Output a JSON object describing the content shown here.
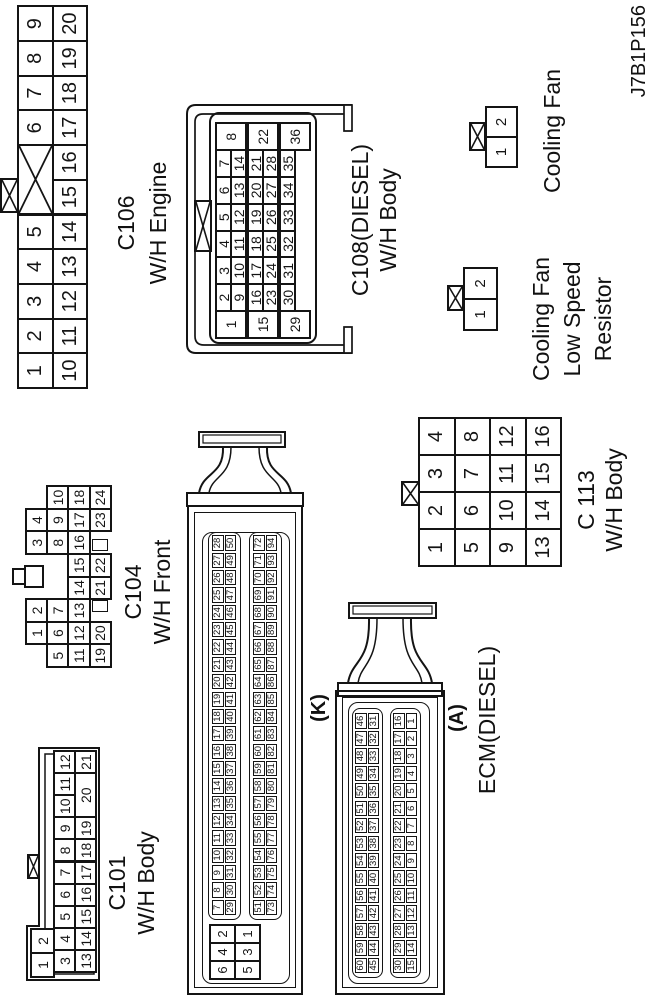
{
  "page_code": "J7B1P156",
  "connectors": {
    "c101": {
      "title": "C101",
      "subtitle": "W/H Body",
      "rows": {
        "row1": [
          "1",
          "2"
        ],
        "row2": [
          "3",
          "4",
          "5",
          "6",
          "7",
          "8",
          "9",
          "10",
          "11",
          "12"
        ],
        "row3": [
          "13",
          "14",
          "15",
          "16",
          "17",
          "18",
          "19",
          "20",
          "21"
        ]
      }
    },
    "c104": {
      "title": "C104",
      "subtitle": "W/H Front",
      "rows": {
        "row1": [
          "1",
          "2",
          "3",
          "4"
        ],
        "row2": [
          "5",
          "6",
          "7",
          "8",
          "9",
          "10"
        ],
        "row3": [
          "11",
          "12",
          "13",
          "14",
          "15",
          "16",
          "17",
          "18"
        ],
        "row4": [
          "19",
          "20",
          "21",
          "22",
          "23",
          "24"
        ]
      }
    },
    "c106": {
      "title": "C106",
      "subtitle": "W/H Engine",
      "rows": {
        "row1": [
          "1",
          "2",
          "3",
          "4",
          "5",
          "6",
          "7",
          "8",
          "9"
        ],
        "row2": [
          "10",
          "11",
          "12",
          "13",
          "14",
          "15",
          "16",
          "17",
          "18",
          "19",
          "20"
        ]
      }
    },
    "c108": {
      "title": "C108(DIESEL)",
      "subtitle": "W/H Body",
      "rows": {
        "row1": [
          "1",
          "2",
          "3",
          "4",
          "5",
          "6",
          "7",
          "8"
        ],
        "row2": [
          "9",
          "10",
          "11",
          "12",
          "13",
          "14"
        ],
        "row3": [
          "15",
          "16",
          "17",
          "18",
          "19",
          "20",
          "21",
          "22"
        ],
        "row4": [
          "23",
          "24",
          "25",
          "26",
          "27",
          "28"
        ],
        "row5": [
          "29",
          "30",
          "31",
          "32",
          "33",
          "34",
          "35",
          "36"
        ]
      }
    },
    "c113": {
      "title": "C 113",
      "subtitle": "W/H Body",
      "rows": {
        "row1": [
          "1",
          "2",
          "3",
          "4"
        ],
        "row2": [
          "5",
          "6",
          "7",
          "8"
        ],
        "row3": [
          "9",
          "10",
          "11",
          "12"
        ],
        "row4": [
          "13",
          "14",
          "15",
          "16"
        ]
      }
    },
    "cooling_fan": {
      "title": "Cooling Fan",
      "pins": [
        "1",
        "2"
      ]
    },
    "cooling_fan_resistor": {
      "title_lines": [
        "Cooling Fan",
        "Low Speed",
        "Resistor"
      ],
      "pins": [
        "1",
        "2"
      ]
    },
    "ecm": {
      "title": "ECM(DIESEL)",
      "k": {
        "label": "(K)",
        "power_pins": [
          [
            "6",
            "4",
            "2"
          ],
          [
            "5",
            "3",
            "1"
          ]
        ],
        "rows": [
          [
            "7",
            "8",
            "9",
            "10",
            "11",
            "12",
            "13",
            "14",
            "15",
            "16",
            "17",
            "18",
            "19",
            "20",
            "21",
            "22",
            "23",
            "24",
            "25",
            "26",
            "27",
            "28"
          ],
          [
            "29",
            "30",
            "31",
            "32",
            "33",
            "34",
            "35",
            "36",
            "37",
            "38",
            "39",
            "40",
            "41",
            "42",
            "43",
            "44",
            "45",
            "46",
            "47",
            "48",
            "49",
            "50"
          ],
          [
            "51",
            "52",
            "53",
            "54",
            "55",
            "56",
            "57",
            "58",
            "59",
            "60",
            "61",
            "62",
            "63",
            "64",
            "65",
            "66",
            "67",
            "68",
            "69",
            "70",
            "71",
            "72"
          ],
          [
            "73",
            "74",
            "75",
            "76",
            "77",
            "78",
            "79",
            "80",
            "81",
            "82",
            "83",
            "84",
            "85",
            "86",
            "87",
            "88",
            "89",
            "90",
            "91",
            "92",
            "93",
            "94"
          ]
        ]
      },
      "a": {
        "label": "(A)",
        "rows": [
          [
            "60",
            "59",
            "58",
            "57",
            "56",
            "55",
            "54",
            "53",
            "52",
            "51",
            "50",
            "49",
            "48",
            "47",
            "46"
          ],
          [
            "45",
            "44",
            "43",
            "42",
            "41",
            "40",
            "39",
            "38",
            "37",
            "36",
            "35",
            "34",
            "33",
            "32",
            "31"
          ],
          [
            "30",
            "29",
            "28",
            "27",
            "26",
            "25",
            "24",
            "23",
            "22",
            "21",
            "20",
            "19",
            "18",
            "17",
            "16"
          ],
          [
            "15",
            "14",
            "13",
            "12",
            "11",
            "10",
            "9",
            "8",
            "7",
            "6",
            "5",
            "4",
            "3",
            "2",
            "1"
          ]
        ]
      }
    }
  }
}
